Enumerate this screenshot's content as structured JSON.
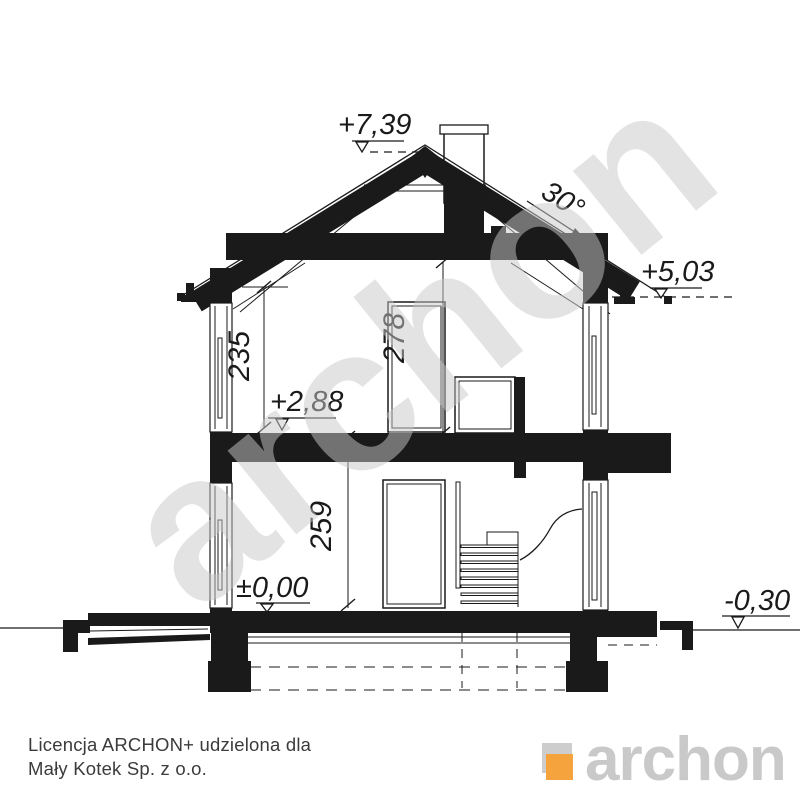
{
  "drawing": {
    "title": "house-cross-section",
    "levels": {
      "ridge": "+7,39",
      "eaves": "+5,03",
      "upper_floor": "+2,88",
      "ground_floor": "±0,00",
      "terrain": "-0,30"
    },
    "dimensions": {
      "roof_angle": "30°",
      "upper_room_knee_height": "235",
      "upper_room_height": "278",
      "ground_room_height": "259"
    },
    "watermark": "archon"
  },
  "footer": {
    "license_line1": "Licencja ARCHON+ udzielona dla",
    "license_line2": "Mały Kotek Sp. z o.o.",
    "logo_text": "archon"
  },
  "colors": {
    "ink": "#1a1a1a",
    "logo_gray": "#cdcdcd",
    "logo_text_gray": "#c9c9c9",
    "logo_orange": "#f5a33c",
    "watermark_gray": "#c9c9c9"
  }
}
